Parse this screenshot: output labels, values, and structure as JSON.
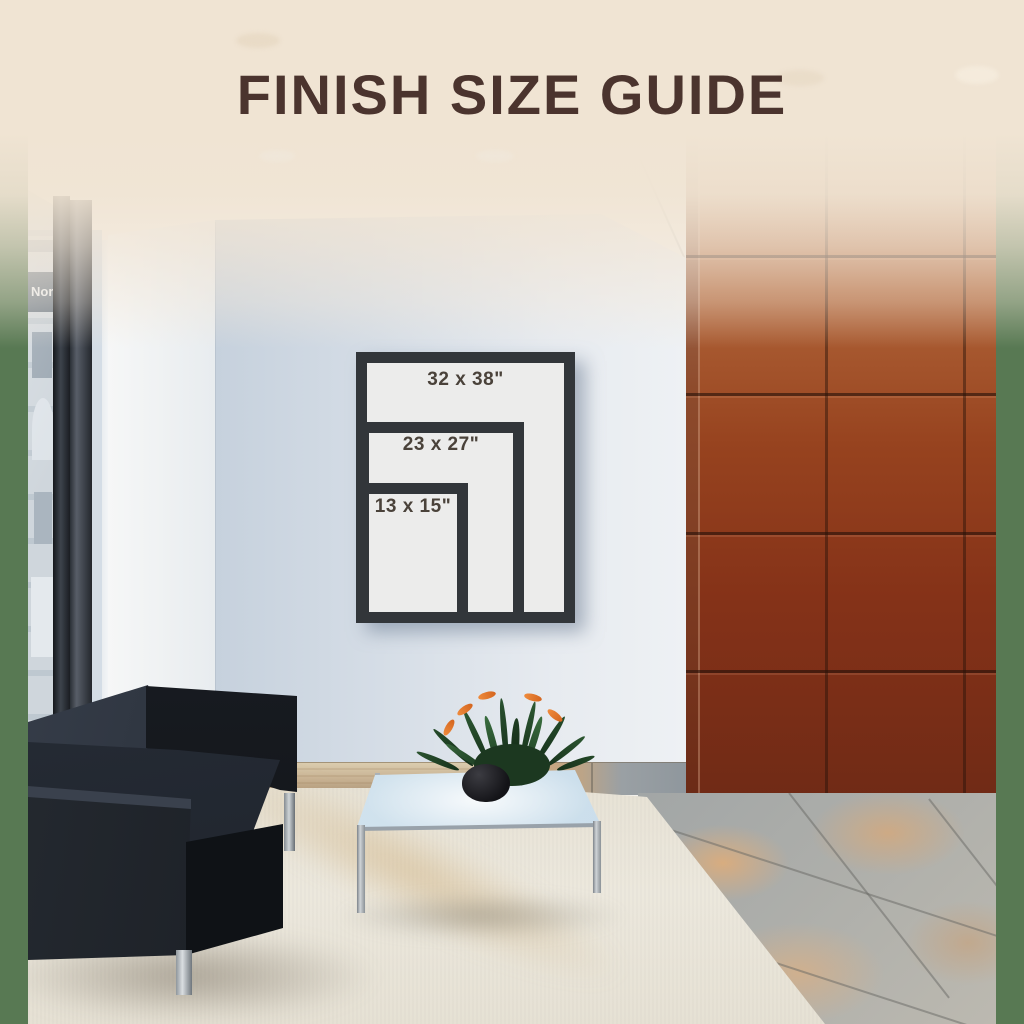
{
  "title": "FINISH SIZE GUIDE",
  "frames": [
    {
      "id": "large",
      "label": "32 x 38\""
    },
    {
      "id": "medium",
      "label": "23 x 27\""
    },
    {
      "id": "small",
      "label": "13 x 15\""
    }
  ],
  "window_sign_text": "Nor",
  "palette": {
    "page_margin_green": "#587953",
    "header_cream": "#f0e4d3",
    "title_brown": "#4b342e",
    "frame_black": "#32363a",
    "frame_mat_white": "#ececeb",
    "size_label_gray": "#4a423a",
    "tile_wall_rust": "#8a3a1e",
    "feature_wall_blue": "#d3dce6",
    "carpet_beige": "#e9e5d9",
    "sofa_black": "#1b2028"
  }
}
